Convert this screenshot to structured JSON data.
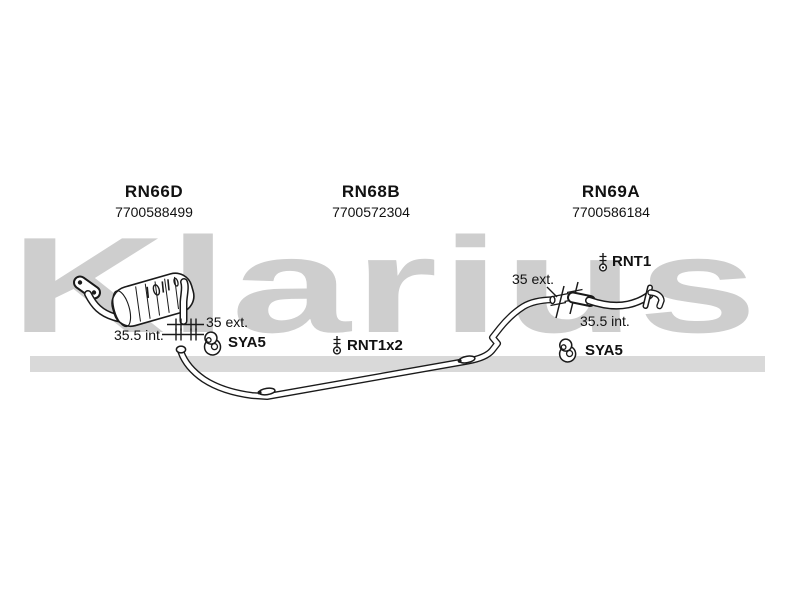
{
  "watermark": {
    "text": "Klarius"
  },
  "colors": {
    "background": "#ffffff",
    "drawing": "#1a1a1a",
    "watermark_text": "#cecece",
    "watermark_band": "#d9d9d9"
  },
  "parts": [
    {
      "code": "RN66D",
      "part_number": "7700588499"
    },
    {
      "code": "RN68B",
      "part_number": "7700572304"
    },
    {
      "code": "RN69A",
      "part_number": "7700586184"
    }
  ],
  "annotations": {
    "front_joint_ext": "35 ext.",
    "front_joint_int": "35.5 int.",
    "front_hanger": "SYA5",
    "mid_clamp": "RNT1x2",
    "rear_joint_ext": "35 ext.",
    "rear_joint_int": "35.5 int.",
    "rear_clamp": "RNT1",
    "rear_hanger": "SYA5"
  },
  "icons": {
    "hanger": "rubber-hanger-icon",
    "clamp": "pipe-clamp-icon"
  }
}
